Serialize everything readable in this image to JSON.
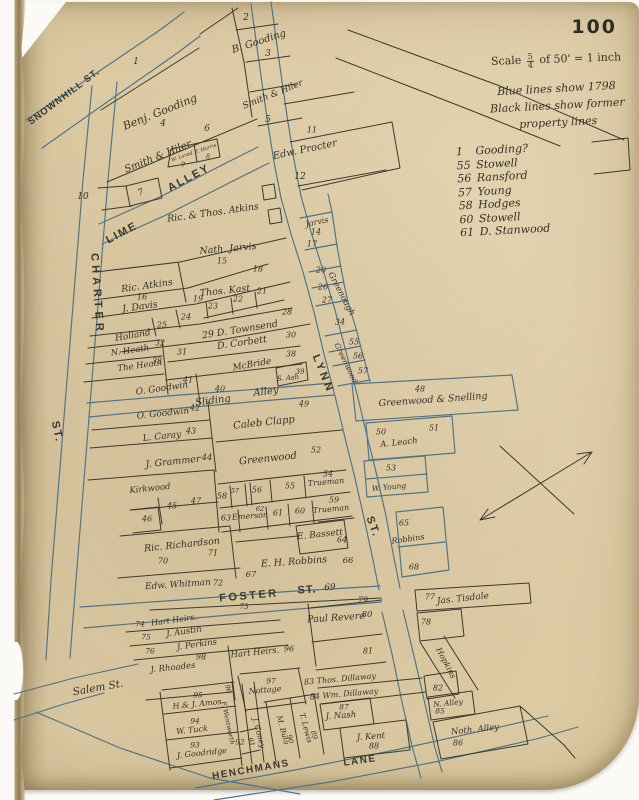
{
  "page": {
    "number": "100"
  },
  "scale": {
    "word": "Scale",
    "numerator": "5",
    "denominator": "4",
    "rest": "of 50' = 1 inch"
  },
  "notes": [
    "Blue lines show 1798",
    "Black lines show former",
    "property lines"
  ],
  "legend": [
    {
      "num": "1",
      "name": "Gooding?"
    },
    {
      "num": "55",
      "name": "Stowell"
    },
    {
      "num": "56",
      "name": "Ransford"
    },
    {
      "num": "57",
      "name": "Young"
    },
    {
      "num": "58",
      "name": "Hodges"
    },
    {
      "num": "60",
      "name": "Stowell"
    },
    {
      "num": "61",
      "name": "D. Stanwood"
    }
  ],
  "colors": {
    "paper": "#dccaa3",
    "blue": "#4e7386",
    "black": "#3c3a2f",
    "ink": "#35322a"
  },
  "map": {
    "labels": [
      {
        "t": "SNOWNHILL ST.",
        "x": 64,
        "y": 97,
        "r": -37,
        "s": 9.5,
        "ls": 1,
        "st": 1
      },
      {
        "t": "LIME",
        "x": 122,
        "y": 233,
        "r": -28,
        "s": 11,
        "ls": 2,
        "st": 1
      },
      {
        "t": "ALLEY",
        "x": 189,
        "y": 178,
        "r": -28,
        "s": 11,
        "ls": 2,
        "st": 1
      },
      {
        "t": "CHARTER",
        "x": 97,
        "y": 294,
        "r": 86,
        "s": 11,
        "ls": 4,
        "st": 1
      },
      {
        "t": "ST.",
        "x": 57,
        "y": 432,
        "r": 78,
        "s": 11,
        "ls": 2,
        "st": 1
      },
      {
        "t": "LYNN",
        "x": 323,
        "y": 374,
        "r": 68,
        "s": 11,
        "ls": 3,
        "st": 1
      },
      {
        "t": "ST.",
        "x": 373,
        "y": 527,
        "r": 70,
        "s": 11,
        "ls": 2,
        "st": 1
      },
      {
        "t": "FOSTER",
        "x": 249,
        "y": 596,
        "r": -5,
        "s": 11,
        "ls": 2.5,
        "st": 1
      },
      {
        "t": "ST.",
        "x": 307,
        "y": 590,
        "r": -4,
        "s": 11,
        "ls": 1,
        "st": 1
      },
      {
        "t": "69",
        "x": 330,
        "y": 588,
        "r": -4,
        "s": 9
      },
      {
        "t": "HENCHMANS",
        "x": 251,
        "y": 770,
        "r": -10,
        "s": 10,
        "ls": 1.5,
        "st": 1
      },
      {
        "t": "LANE",
        "x": 360,
        "y": 761,
        "r": -8,
        "s": 10,
        "ls": 1.5,
        "st": 1
      },
      {
        "t": "Salem St.",
        "x": 98,
        "y": 688,
        "r": -10,
        "s": 10.5
      },
      {
        "t": "Sliding",
        "x": 213,
        "y": 401,
        "r": -7,
        "s": 10
      },
      {
        "t": "Alley",
        "x": 266,
        "y": 392,
        "r": -7,
        "s": 10
      },
      {
        "t": "1",
        "x": 136,
        "y": 62,
        "r": 0,
        "s": 9
      },
      {
        "t": "2",
        "x": 246,
        "y": 18,
        "r": 0,
        "s": 9
      },
      {
        "t": "B. Gooding",
        "x": 259,
        "y": 42,
        "r": -18,
        "s": 10
      },
      {
        "t": "3",
        "x": 268,
        "y": 54,
        "r": 0,
        "s": 9
      },
      {
        "t": "Benj. Gooding",
        "x": 160,
        "y": 112,
        "r": -22,
        "s": 11
      },
      {
        "t": "4",
        "x": 163,
        "y": 124,
        "r": 0,
        "s": 9
      },
      {
        "t": "Smith & Hiler",
        "x": 273,
        "y": 95,
        "r": -22,
        "s": 9
      },
      {
        "t": "5",
        "x": 268,
        "y": 120,
        "r": 0,
        "s": 9
      },
      {
        "t": "Smith & Hiler",
        "x": 158,
        "y": 157,
        "r": -22,
        "s": 10
      },
      {
        "t": "6",
        "x": 207,
        "y": 129,
        "r": 0,
        "s": 9
      },
      {
        "t": "W. Lorod",
        "x": 182,
        "y": 157,
        "r": -20,
        "s": 5
      },
      {
        "t": "9",
        "x": 183,
        "y": 165,
        "r": 0,
        "s": 6
      },
      {
        "t": "T. Harris",
        "x": 206,
        "y": 149,
        "r": -20,
        "s": 5
      },
      {
        "t": "8",
        "x": 208,
        "y": 157,
        "r": 0,
        "s": 6
      },
      {
        "t": "10",
        "x": 83,
        "y": 197,
        "r": 0,
        "s": 9
      },
      {
        "t": "7",
        "x": 141,
        "y": 193,
        "r": -25,
        "s": 9
      },
      {
        "t": "11",
        "x": 312,
        "y": 130,
        "r": 0,
        "s": 8
      },
      {
        "t": "Edw. Procter",
        "x": 305,
        "y": 150,
        "r": -12,
        "s": 10
      },
      {
        "t": "12",
        "x": 300,
        "y": 177,
        "r": 0,
        "s": 9
      },
      {
        "t": "Ric. & Thos. Atkins",
        "x": 213,
        "y": 213,
        "r": -8,
        "s": 9.5
      },
      {
        "t": "Jarvis",
        "x": 317,
        "y": 222,
        "r": -12,
        "s": 8
      },
      {
        "t": "14",
        "x": 316,
        "y": 232,
        "r": 0,
        "s": 8
      },
      {
        "t": "17",
        "x": 312,
        "y": 244,
        "r": 0,
        "s": 8
      },
      {
        "t": "Nath. Jarvis",
        "x": 228,
        "y": 249,
        "r": -5,
        "s": 9.5
      },
      {
        "t": "15",
        "x": 222,
        "y": 261,
        "r": 0,
        "s": 8
      },
      {
        "t": "18",
        "x": 258,
        "y": 269,
        "r": 0,
        "s": 8
      },
      {
        "t": "20",
        "x": 321,
        "y": 270,
        "r": 0,
        "s": 8
      },
      {
        "t": "Ric. Atkins",
        "x": 147,
        "y": 286,
        "r": -8,
        "s": 9.5
      },
      {
        "t": "16",
        "x": 142,
        "y": 297,
        "r": 0,
        "s": 8
      },
      {
        "t": "Thos. Kast",
        "x": 225,
        "y": 291,
        "r": -6,
        "s": 9.5
      },
      {
        "t": "21",
        "x": 262,
        "y": 291,
        "r": 0,
        "s": 8
      },
      {
        "t": "22",
        "x": 238,
        "y": 299,
        "r": 0,
        "s": 8
      },
      {
        "t": "23",
        "x": 213,
        "y": 306,
        "r": 0,
        "s": 8
      },
      {
        "t": "26",
        "x": 323,
        "y": 287,
        "r": 0,
        "s": 8
      },
      {
        "t": "27",
        "x": 327,
        "y": 300,
        "r": 0,
        "s": 8
      },
      {
        "t": "Greenough",
        "x": 341,
        "y": 294,
        "r": 62,
        "s": 8.5
      },
      {
        "t": "J. Davis",
        "x": 140,
        "y": 307,
        "r": -8,
        "s": 9.5
      },
      {
        "t": "19",
        "x": 198,
        "y": 299,
        "r": 0,
        "s": 8
      },
      {
        "t": "24",
        "x": 186,
        "y": 317,
        "r": 0,
        "s": 8
      },
      {
        "t": "25",
        "x": 162,
        "y": 325,
        "r": 0,
        "s": 8
      },
      {
        "t": "28",
        "x": 287,
        "y": 312,
        "r": 0,
        "s": 8
      },
      {
        "t": "29 D. Townsend",
        "x": 240,
        "y": 330,
        "r": -9,
        "s": 9.5
      },
      {
        "t": "30",
        "x": 291,
        "y": 335,
        "r": 0,
        "s": 8
      },
      {
        "t": "34",
        "x": 340,
        "y": 322,
        "r": 0,
        "s": 8
      },
      {
        "t": "Holland",
        "x": 133,
        "y": 336,
        "r": -10,
        "s": 9
      },
      {
        "t": "32",
        "x": 160,
        "y": 343,
        "r": 0,
        "s": 8
      },
      {
        "t": "N. Heath",
        "x": 130,
        "y": 351,
        "r": -8,
        "s": 8.5
      },
      {
        "t": "31",
        "x": 182,
        "y": 352,
        "r": 0,
        "s": 8
      },
      {
        "t": "D. Corbett",
        "x": 242,
        "y": 343,
        "r": -8,
        "s": 9.5
      },
      {
        "t": "The Heath",
        "x": 140,
        "y": 366,
        "r": -8,
        "s": 8.5
      },
      {
        "t": "33",
        "x": 157,
        "y": 361,
        "r": 0,
        "s": 8
      },
      {
        "t": "McBride",
        "x": 252,
        "y": 365,
        "r": -10,
        "s": 9
      },
      {
        "t": "38",
        "x": 291,
        "y": 354,
        "r": 0,
        "s": 8
      },
      {
        "t": "S. Ash",
        "x": 288,
        "y": 378,
        "r": -5,
        "s": 7
      },
      {
        "t": "39",
        "x": 300,
        "y": 372,
        "r": 0,
        "s": 7
      },
      {
        "t": "O. Goodwin",
        "x": 162,
        "y": 389,
        "r": -8,
        "s": 9
      },
      {
        "t": "41",
        "x": 188,
        "y": 380,
        "r": 0,
        "s": 8
      },
      {
        "t": "40",
        "x": 220,
        "y": 389,
        "r": 0,
        "s": 8
      },
      {
        "t": "55",
        "x": 354,
        "y": 342,
        "r": 0,
        "s": 8
      },
      {
        "t": "56",
        "x": 358,
        "y": 356,
        "r": 0,
        "s": 8
      },
      {
        "t": "57",
        "x": 363,
        "y": 371,
        "r": 0,
        "s": 8
      },
      {
        "t": "Greenwood",
        "x": 346,
        "y": 363,
        "r": 64,
        "s": 7.5
      },
      {
        "t": "48",
        "x": 420,
        "y": 389,
        "r": 0,
        "s": 8
      },
      {
        "t": "Greenwood & Snelling",
        "x": 433,
        "y": 400,
        "r": -4,
        "s": 9.5
      },
      {
        "t": "O. Goodwin",
        "x": 163,
        "y": 414,
        "r": -6,
        "s": 9
      },
      {
        "t": "42",
        "x": 195,
        "y": 408,
        "r": 0,
        "s": 8
      },
      {
        "t": "49",
        "x": 304,
        "y": 404,
        "r": 0,
        "s": 8
      },
      {
        "t": "Caleb Clapp",
        "x": 264,
        "y": 423,
        "r": -6,
        "s": 10
      },
      {
        "t": "L. Caray",
        "x": 162,
        "y": 437,
        "r": -6,
        "s": 9
      },
      {
        "t": "43",
        "x": 191,
        "y": 431,
        "r": 0,
        "s": 8
      },
      {
        "t": "50",
        "x": 381,
        "y": 432,
        "r": 0,
        "s": 8
      },
      {
        "t": "51",
        "x": 434,
        "y": 428,
        "r": 0,
        "s": 8
      },
      {
        "t": "A. Leach",
        "x": 399,
        "y": 443,
        "r": -6,
        "s": 8.5
      },
      {
        "t": "J. Grammer",
        "x": 173,
        "y": 462,
        "r": -6,
        "s": 9.5
      },
      {
        "t": "44",
        "x": 207,
        "y": 458,
        "r": 0,
        "s": 8.5
      },
      {
        "t": "Greenwood",
        "x": 268,
        "y": 459,
        "r": -6,
        "s": 10
      },
      {
        "t": "52",
        "x": 316,
        "y": 450,
        "r": 0,
        "s": 8
      },
      {
        "t": "53",
        "x": 391,
        "y": 468,
        "r": 0,
        "s": 8
      },
      {
        "t": "W. Young",
        "x": 389,
        "y": 487,
        "r": -6,
        "s": 7.5
      },
      {
        "t": "Kirkwood",
        "x": 150,
        "y": 489,
        "r": -6,
        "s": 8.5
      },
      {
        "t": "45",
        "x": 172,
        "y": 506,
        "r": 0,
        "s": 8
      },
      {
        "t": "47",
        "x": 196,
        "y": 501,
        "r": 0,
        "s": 8
      },
      {
        "t": "46",
        "x": 147,
        "y": 519,
        "r": 0,
        "s": 8
      },
      {
        "t": "58",
        "x": 222,
        "y": 496,
        "r": 0,
        "s": 8
      },
      {
        "t": "57",
        "x": 235,
        "y": 491,
        "r": 0,
        "s": 6.5
      },
      {
        "t": "56",
        "x": 257,
        "y": 490,
        "r": 0,
        "s": 8
      },
      {
        "t": "55",
        "x": 290,
        "y": 486,
        "r": 0,
        "s": 8
      },
      {
        "t": "54",
        "x": 328,
        "y": 474,
        "r": 0,
        "s": 8
      },
      {
        "t": "Trueman",
        "x": 326,
        "y": 482,
        "r": -5,
        "s": 8
      },
      {
        "t": "59",
        "x": 334,
        "y": 500,
        "r": 0,
        "s": 8
      },
      {
        "t": "Trueman",
        "x": 331,
        "y": 509,
        "r": -5,
        "s": 8
      },
      {
        "t": "60",
        "x": 300,
        "y": 511,
        "r": 0,
        "s": 8
      },
      {
        "t": "61",
        "x": 278,
        "y": 513,
        "r": 0,
        "s": 8
      },
      {
        "t": "62",
        "x": 260,
        "y": 509,
        "r": 0,
        "s": 6.5
      },
      {
        "t": "Emerson",
        "x": 250,
        "y": 516,
        "r": -4,
        "s": 8
      },
      {
        "t": "63",
        "x": 226,
        "y": 518,
        "r": 0,
        "s": 8
      },
      {
        "t": "E. Bassett",
        "x": 320,
        "y": 535,
        "r": -6,
        "s": 9
      },
      {
        "t": "64",
        "x": 342,
        "y": 540,
        "r": 0,
        "s": 8
      },
      {
        "t": "65",
        "x": 404,
        "y": 523,
        "r": 0,
        "s": 8
      },
      {
        "t": "Robbins",
        "x": 408,
        "y": 539,
        "r": -8,
        "s": 8
      },
      {
        "t": "68",
        "x": 414,
        "y": 567,
        "r": 0,
        "s": 8
      },
      {
        "t": "Ric. Richardson",
        "x": 182,
        "y": 545,
        "r": -6,
        "s": 9.5
      },
      {
        "t": "71",
        "x": 213,
        "y": 553,
        "r": 0,
        "s": 8
      },
      {
        "t": "70",
        "x": 163,
        "y": 561,
        "r": 0,
        "s": 8
      },
      {
        "t": "E. H. Robbins",
        "x": 294,
        "y": 562,
        "r": -4,
        "s": 9.5
      },
      {
        "t": "66",
        "x": 348,
        "y": 561,
        "r": 0,
        "s": 8.5
      },
      {
        "t": "67",
        "x": 251,
        "y": 575,
        "r": 0,
        "s": 8.5
      },
      {
        "t": "Edw. Whitman",
        "x": 178,
        "y": 585,
        "r": -4,
        "s": 9
      },
      {
        "t": "72",
        "x": 218,
        "y": 583,
        "r": 0,
        "s": 8
      },
      {
        "t": "73",
        "x": 244,
        "y": 607,
        "r": 0,
        "s": 7
      },
      {
        "t": "79",
        "x": 363,
        "y": 600,
        "r": 0,
        "s": 8
      },
      {
        "t": "Paul Revere",
        "x": 336,
        "y": 618,
        "r": -4,
        "s": 9.5
      },
      {
        "t": "80",
        "x": 367,
        "y": 615,
        "r": 0,
        "s": 8.5
      },
      {
        "t": "81",
        "x": 368,
        "y": 651,
        "r": 0,
        "s": 8
      },
      {
        "t": "77",
        "x": 430,
        "y": 597,
        "r": 0,
        "s": 8
      },
      {
        "t": "Jas. Tisdale",
        "x": 463,
        "y": 599,
        "r": -6,
        "s": 9
      },
      {
        "t": "78",
        "x": 426,
        "y": 622,
        "r": 0,
        "s": 8
      },
      {
        "t": "Hopkins",
        "x": 446,
        "y": 663,
        "r": 62,
        "s": 8
      },
      {
        "t": "82",
        "x": 438,
        "y": 688,
        "r": 0,
        "s": 8
      },
      {
        "t": "N. Alley",
        "x": 448,
        "y": 703,
        "r": -6,
        "s": 7.5
      },
      {
        "t": "85",
        "x": 440,
        "y": 711,
        "r": 0,
        "s": 7.5
      },
      {
        "t": "Noth. Alley",
        "x": 475,
        "y": 730,
        "r": -6,
        "s": 8.5
      },
      {
        "t": "86",
        "x": 458,
        "y": 743,
        "r": 0,
        "s": 8
      },
      {
        "t": "74",
        "x": 140,
        "y": 624,
        "r": 0,
        "s": 7.5
      },
      {
        "t": "Hart Heirs.",
        "x": 174,
        "y": 620,
        "r": -8,
        "s": 8
      },
      {
        "t": "75",
        "x": 146,
        "y": 637,
        "r": 0,
        "s": 7.5
      },
      {
        "t": "J. Austin",
        "x": 184,
        "y": 632,
        "r": -8,
        "s": 8.5
      },
      {
        "t": "76",
        "x": 150,
        "y": 651,
        "r": 0,
        "s": 7.5
      },
      {
        "t": "J. Perkins",
        "x": 197,
        "y": 645,
        "r": -8,
        "s": 8.5
      },
      {
        "t": "J. Rhoades",
        "x": 173,
        "y": 668,
        "r": -6,
        "s": 8.5
      },
      {
        "t": "98",
        "x": 201,
        "y": 657,
        "r": 0,
        "s": 8
      },
      {
        "t": "Hart Heirs.",
        "x": 255,
        "y": 653,
        "r": -6,
        "s": 8.5
      },
      {
        "t": "96",
        "x": 289,
        "y": 649,
        "r": 0,
        "s": 8
      },
      {
        "t": "83 Thos. Dillaway",
        "x": 340,
        "y": 679,
        "r": -5,
        "s": 8
      },
      {
        "t": "84 Wm. Dillaway",
        "x": 344,
        "y": 694,
        "r": -5,
        "s": 8
      },
      {
        "t": "97",
        "x": 271,
        "y": 681,
        "r": 0,
        "s": 7.5
      },
      {
        "t": "Nottage",
        "x": 265,
        "y": 690,
        "r": -5,
        "s": 8
      },
      {
        "t": "96",
        "x": 228,
        "y": 689,
        "r": 75,
        "s": 7
      },
      {
        "t": "F. Wentworth",
        "x": 228,
        "y": 723,
        "r": 78,
        "s": 6.5
      },
      {
        "t": "92",
        "x": 240,
        "y": 742,
        "r": 0,
        "s": 7.5
      },
      {
        "t": "95",
        "x": 198,
        "y": 695,
        "r": 0,
        "s": 7.5
      },
      {
        "t": "H.& J. Amos",
        "x": 197,
        "y": 704,
        "r": -6,
        "s": 8
      },
      {
        "t": "94",
        "x": 195,
        "y": 721,
        "r": 0,
        "s": 7.5
      },
      {
        "t": "W. Tuck",
        "x": 192,
        "y": 730,
        "r": -6,
        "s": 8
      },
      {
        "t": "93",
        "x": 195,
        "y": 745,
        "r": 0,
        "s": 7.5
      },
      {
        "t": "J. Goodridge",
        "x": 202,
        "y": 753,
        "r": -6,
        "s": 8
      },
      {
        "t": "J. Coney",
        "x": 259,
        "y": 733,
        "r": 75,
        "s": 7.5
      },
      {
        "t": "91",
        "x": 251,
        "y": 742,
        "r": 75,
        "s": 7
      },
      {
        "t": "M. Bulo",
        "x": 283,
        "y": 730,
        "r": 75,
        "s": 7.5
      },
      {
        "t": "90",
        "x": 290,
        "y": 739,
        "r": 75,
        "s": 7
      },
      {
        "t": "T. Lewis",
        "x": 306,
        "y": 728,
        "r": 75,
        "s": 7.5
      },
      {
        "t": "89",
        "x": 314,
        "y": 735,
        "r": 75,
        "s": 7
      },
      {
        "t": "87",
        "x": 344,
        "y": 707,
        "r": 0,
        "s": 7.5
      },
      {
        "t": "J. Nash",
        "x": 341,
        "y": 716,
        "r": -4,
        "s": 8.5
      },
      {
        "t": "J. Kent",
        "x": 371,
        "y": 737,
        "r": -4,
        "s": 8.5
      },
      {
        "t": "88",
        "x": 374,
        "y": 746,
        "r": 0,
        "s": 8
      }
    ]
  }
}
